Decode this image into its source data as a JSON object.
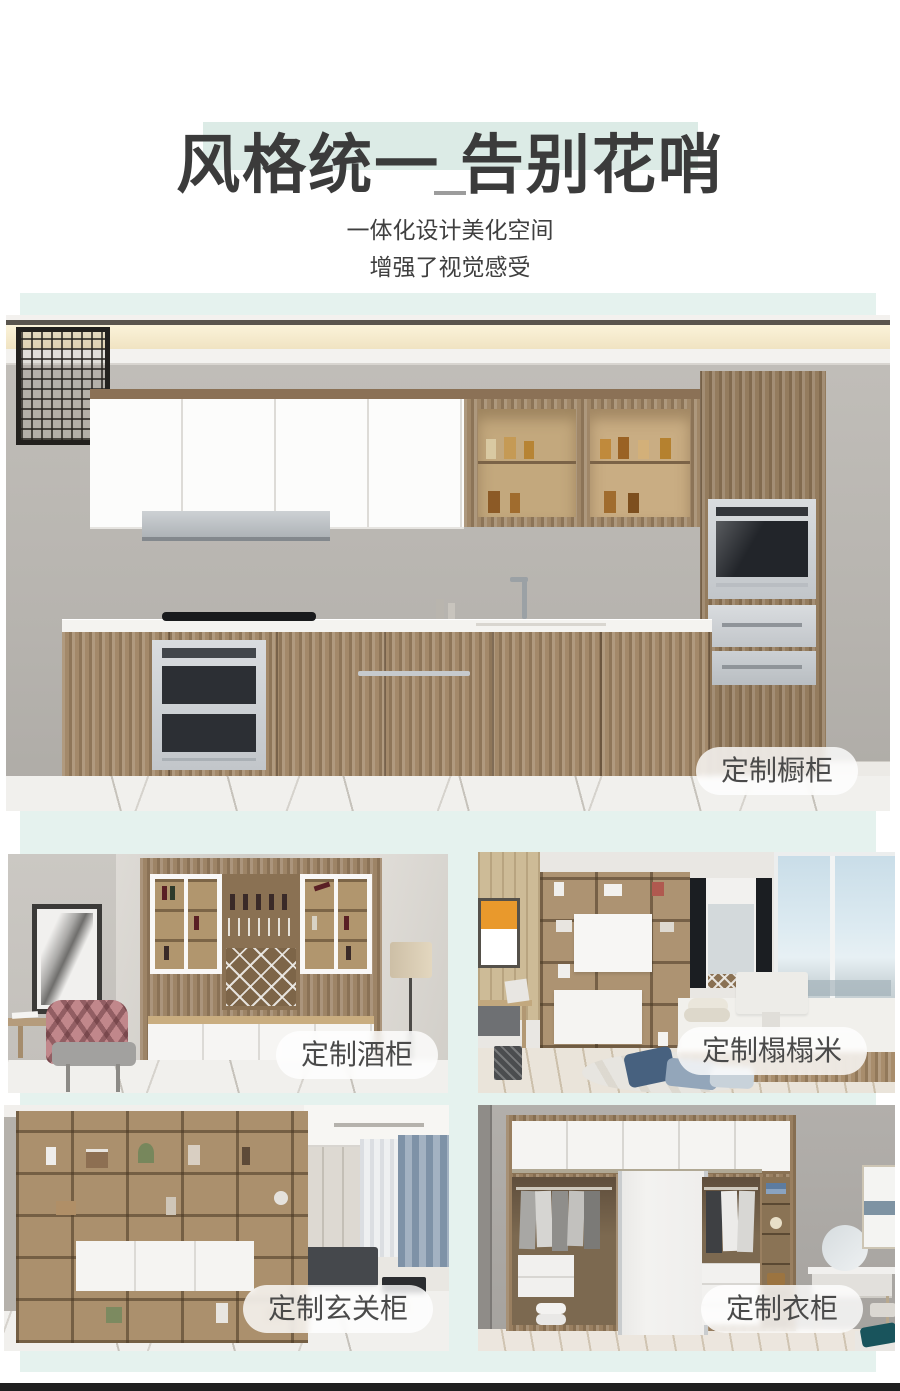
{
  "header": {
    "title": "风格统一 告别花哨",
    "subtitle_lines": [
      "一体化设计美化空间",
      "增强了视觉感受"
    ]
  },
  "sections": {
    "kitchen": {
      "label": "定制橱柜"
    },
    "wine": {
      "label": "定制酒柜"
    },
    "tatami": {
      "label": "定制榻榻米"
    },
    "entry": {
      "label": "定制玄关柜"
    },
    "wardrobe": {
      "label": "定制衣柜"
    }
  },
  "colors": {
    "accent_mint": "#e5f2ee",
    "title_highlight": "#dcebe6",
    "next_section_bar": "#1f1f1f",
    "title_text": "#3b3b3b"
  }
}
